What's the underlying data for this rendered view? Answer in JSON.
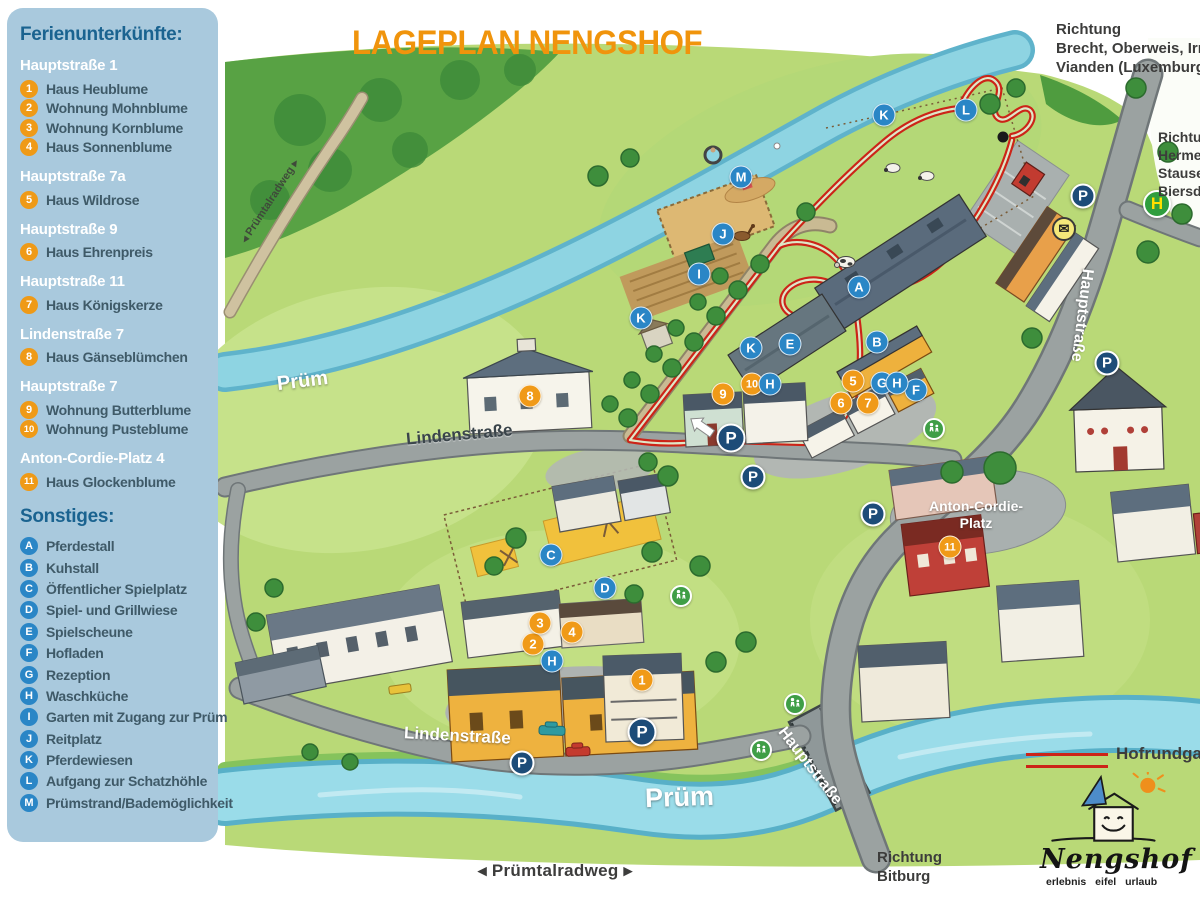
{
  "title": "LAGEPLAN NENGSHOF",
  "sidebar": {
    "heading": "Ferienunterkünfte:",
    "groups": [
      {
        "address": "Hauptstraße 1",
        "items": [
          {
            "n": "1",
            "label": "Haus Heublume"
          },
          {
            "n": "2",
            "label": "Wohnung Mohnblume"
          },
          {
            "n": "3",
            "label": "Wohnung Kornblume"
          },
          {
            "n": "4",
            "label": "Haus Sonnenblume"
          }
        ]
      },
      {
        "address": "Hauptstraße 7a",
        "items": [
          {
            "n": "5",
            "label": "Haus Wildrose"
          }
        ]
      },
      {
        "address": "Hauptstraße 9",
        "items": [
          {
            "n": "6",
            "label": "Haus Ehrenpreis"
          }
        ]
      },
      {
        "address": "Hauptstraße 11",
        "items": [
          {
            "n": "7",
            "label": "Haus Königskerze"
          }
        ]
      },
      {
        "address": "Lindenstraße 7",
        "items": [
          {
            "n": "8",
            "label": "Haus Gänseblümchen"
          }
        ]
      },
      {
        "address": "Hauptstraße 7",
        "items": [
          {
            "n": "9",
            "label": "Wohnung Butterblume"
          },
          {
            "n": "10",
            "label": "Wohnung Pusteblume"
          }
        ]
      },
      {
        "address": "Anton-Cordie-Platz 4",
        "items": [
          {
            "n": "11",
            "label": "Haus Glockenblume"
          }
        ]
      }
    ],
    "other_heading": "Sonstiges:",
    "other_items": [
      {
        "n": "A",
        "label": "Pferdestall"
      },
      {
        "n": "B",
        "label": "Kuhstall"
      },
      {
        "n": "C",
        "label": "Öffentlicher Spielplatz"
      },
      {
        "n": "D",
        "label": "Spiel- und Grillwiese"
      },
      {
        "n": "E",
        "label": "Spielscheune"
      },
      {
        "n": "F",
        "label": "Hofladen"
      },
      {
        "n": "G",
        "label": "Rezeption"
      },
      {
        "n": "H",
        "label": "Waschküche"
      },
      {
        "n": "I",
        "label": "Garten mit Zugang zur Prüm"
      },
      {
        "n": "J",
        "label": "Reitplatz"
      },
      {
        "n": "K",
        "label": "Pferdewiesen"
      },
      {
        "n": "L",
        "label": "Aufgang zur Schatzhöhle"
      },
      {
        "n": "M",
        "label": "Prümstrand/Bademöglichkeit"
      }
    ]
  },
  "map_labels": {
    "river_upper": "Prüm",
    "river_lower": "Prüm",
    "street_linden_upper": "Lindenstraße",
    "street_linden_lower": "Lindenstraße",
    "street_haupt_right": "Hauptstraße",
    "street_haupt_bridge": "Hauptstraße",
    "platz_line1": "Anton-Cordie-",
    "platz_line2": "Platz",
    "radweg_path": "◂ Prümtalradweg ▸",
    "radweg_bottom": "◂ Prümtalradweg ▸",
    "direction_top": [
      "Richtung",
      "Brecht, Oberweis, Irrel,",
      "Vianden (Luxemburg)"
    ],
    "direction_right": [
      "Richtung",
      "Hermesdorf",
      "Stausee",
      "Biersdorf"
    ],
    "direction_bottom": [
      "Richtung",
      "Bitburg"
    ],
    "hofrundgang": "Hofrundgang"
  },
  "logo": {
    "name": "Nengshof",
    "tagline": "erlebnis eifel urlaub"
  },
  "colors": {
    "title_orange": "#f0940c",
    "panel_blue": "#a9c9dd",
    "heading_blue": "#1a6390",
    "marker_orange": "#f09a18",
    "marker_blue": "#2a86c6",
    "parking_navy": "#1d4c78",
    "bus_green": "#2f9e3e",
    "route_red": "#cc2418"
  },
  "markers": [
    {
      "t": "num",
      "label": "1",
      "x": 642,
      "y": 680
    },
    {
      "t": "num",
      "label": "2",
      "x": 533,
      "y": 644
    },
    {
      "t": "num",
      "label": "3",
      "x": 540,
      "y": 623
    },
    {
      "t": "num",
      "label": "4",
      "x": 572,
      "y": 632
    },
    {
      "t": "num",
      "label": "5",
      "x": 853,
      "y": 381
    },
    {
      "t": "num",
      "label": "6",
      "x": 841,
      "y": 403
    },
    {
      "t": "num",
      "label": "7",
      "x": 868,
      "y": 403
    },
    {
      "t": "num",
      "label": "8",
      "x": 530,
      "y": 396
    },
    {
      "t": "num",
      "label": "9",
      "x": 723,
      "y": 394
    },
    {
      "t": "num",
      "label": "10",
      "x": 752,
      "y": 384
    },
    {
      "t": "num",
      "label": "11",
      "x": 950,
      "y": 547
    },
    {
      "t": "let",
      "label": "A",
      "x": 859,
      "y": 287
    },
    {
      "t": "let",
      "label": "B",
      "x": 877,
      "y": 342
    },
    {
      "t": "let",
      "label": "C",
      "x": 551,
      "y": 555
    },
    {
      "t": "let",
      "label": "D",
      "x": 605,
      "y": 588
    },
    {
      "t": "let",
      "label": "E",
      "x": 790,
      "y": 344
    },
    {
      "t": "let",
      "label": "F",
      "x": 916,
      "y": 390
    },
    {
      "t": "let",
      "label": "G",
      "x": 882,
      "y": 383
    },
    {
      "t": "let",
      "label": "H",
      "x": 897,
      "y": 383
    },
    {
      "t": "let",
      "label": "H",
      "x": 770,
      "y": 384
    },
    {
      "t": "let",
      "label": "H",
      "x": 552,
      "y": 661
    },
    {
      "t": "let",
      "label": "I",
      "x": 699,
      "y": 274
    },
    {
      "t": "let",
      "label": "J",
      "x": 723,
      "y": 234
    },
    {
      "t": "let",
      "label": "K",
      "x": 641,
      "y": 318
    },
    {
      "t": "let",
      "label": "K",
      "x": 751,
      "y": 348
    },
    {
      "t": "let",
      "label": "K",
      "x": 884,
      "y": 115
    },
    {
      "t": "let",
      "label": "L",
      "x": 966,
      "y": 110
    },
    {
      "t": "let",
      "label": "M",
      "x": 741,
      "y": 177
    },
    {
      "t": "park",
      "label": "P",
      "x": 731,
      "y": 438,
      "big": true
    },
    {
      "t": "park",
      "label": "P",
      "x": 753,
      "y": 477
    },
    {
      "t": "park",
      "label": "P",
      "x": 873,
      "y": 514
    },
    {
      "t": "park",
      "label": "P",
      "x": 1083,
      "y": 196
    },
    {
      "t": "park",
      "label": "P",
      "x": 1107,
      "y": 363
    },
    {
      "t": "park",
      "label": "P",
      "x": 642,
      "y": 732,
      "big": true
    },
    {
      "t": "park",
      "label": "P",
      "x": 522,
      "y": 763
    },
    {
      "t": "bus",
      "label": "H",
      "x": 1157,
      "y": 204
    },
    {
      "t": "post",
      "label": "✉",
      "x": 1064,
      "y": 229
    },
    {
      "t": "dot",
      "label": "",
      "x": 1003,
      "y": 137
    },
    {
      "t": "cross",
      "label": "",
      "x": 934,
      "y": 429
    },
    {
      "t": "cross",
      "label": "",
      "x": 795,
      "y": 704
    },
    {
      "t": "cross",
      "label": "",
      "x": 761,
      "y": 750
    },
    {
      "t": "cross",
      "label": "",
      "x": 681,
      "y": 596
    }
  ]
}
